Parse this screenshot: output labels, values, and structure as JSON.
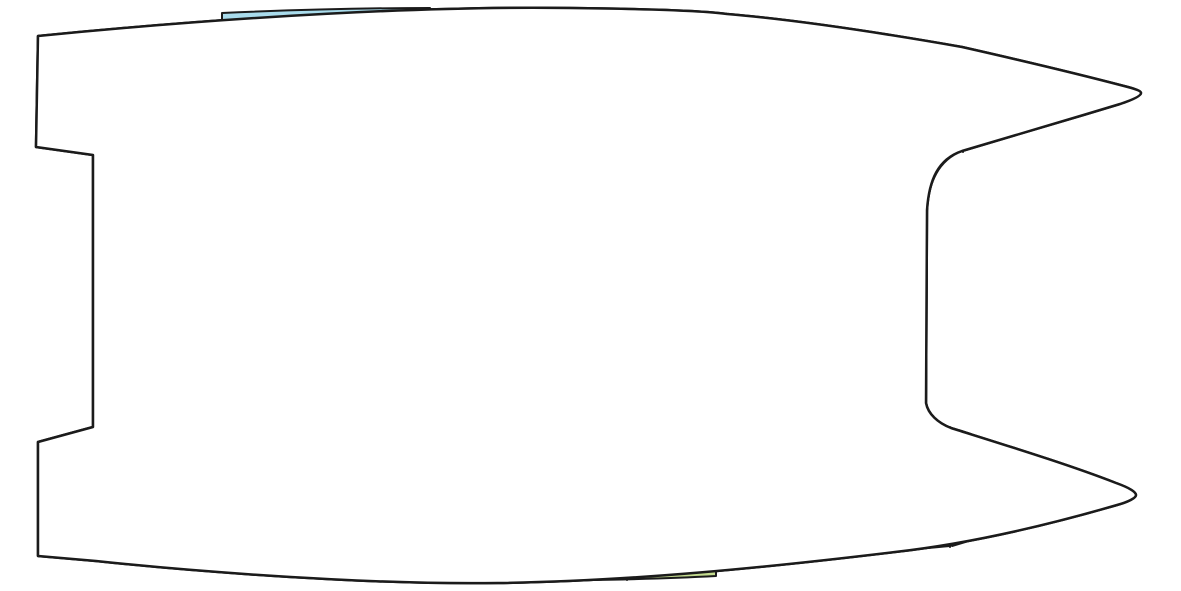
{
  "diagram": {
    "name": "catamaran-floor-plan",
    "kind": "yacht accommodation deck plan, top view, bows pointing right"
  },
  "colors": {
    "outline": "#1b1b1b",
    "hull_white": "#ffffff",
    "cabin_blue": "#a9dcec",
    "bed_teal": "#7cb9c6",
    "forepeak_teal": "#bdd4db",
    "wet_green": "#c4dc8f",
    "salon_orange": "#f8cf87",
    "fixture_dark": "#1c1c1c"
  },
  "icons": {
    "pillow": "rounded white square on berth",
    "door_leaf": "curved blade shape beside berth",
    "stairs": "treaded companionway steps",
    "stove": "rounded square with four burner circles",
    "desk": "rectangle with shelf line",
    "shower_corner_arrow": "corner lines with diagonal arrow",
    "shower_drain_arrow": "downward arrow",
    "toilet": "circle bowl with dark tank",
    "sink": "small rectangle basin",
    "table": "white rectangle with thick ring border"
  }
}
